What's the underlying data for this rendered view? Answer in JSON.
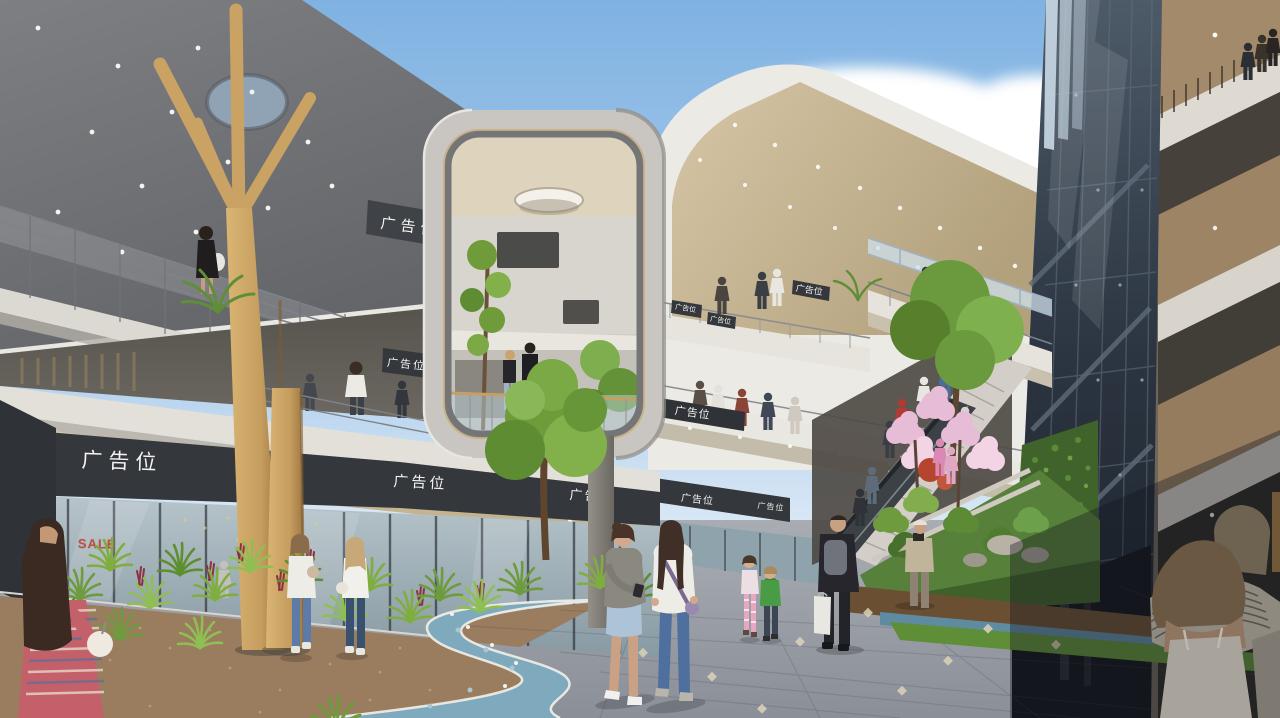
{
  "image": {
    "kind": "architectural-rendering",
    "subject": "open-air shopping mall courtyard with multi-level curved balconies, grand landscaped stair, dark glass stair tower and winding blue mosaic path",
    "lighting": "sunny daytime, blue sky with clouds"
  },
  "signs": {
    "ad_placeholder": "广告位",
    "sale": "SALE"
  },
  "palette": {
    "sky_top": "#7fb2e2",
    "sky_horizon": "#ddeaf6",
    "cloud": "#ffffff",
    "concrete_light": "#e9e7e1",
    "concrete_mid": "#b9b6b0",
    "canopy_dark": "#6e7074",
    "soffit_cream": "#d2c1a0",
    "wood_column": "#c59d5f",
    "glass_dark": "#2b3440",
    "glass_storefront": "#a9bac2",
    "path_blue": "#7fa9bd",
    "terrazzo_brown": "#9a7c5e",
    "paver_grey": "#979ba2",
    "fern_green": "#7fae3e",
    "grass_green": "#5e8f38",
    "blossom_pink": "#e7bcd6",
    "sign_panel_dark": "#34373b",
    "sign_text": "#ffffff",
    "sale_red": "#c23b2e"
  }
}
